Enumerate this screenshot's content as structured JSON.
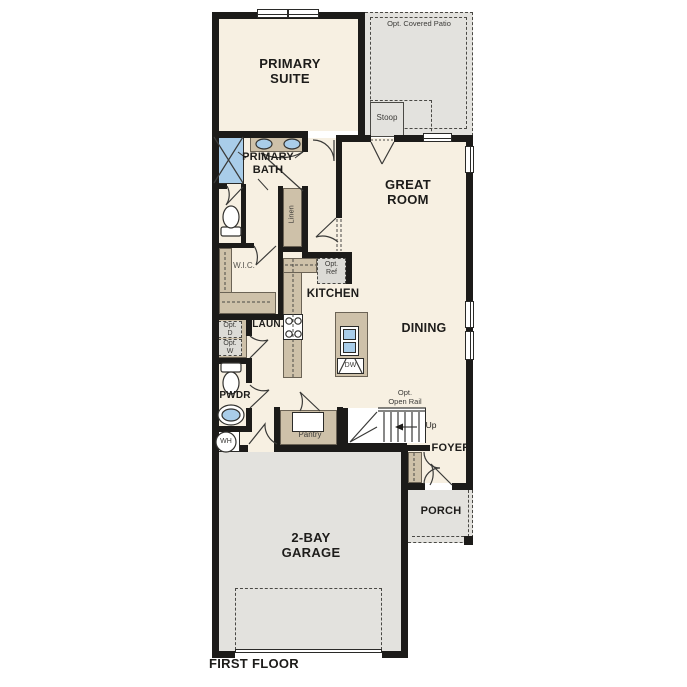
{
  "plan": {
    "title": "FIRST FLOOR",
    "rooms": {
      "primary_suite": "PRIMARY\nSUITE",
      "primary_bath": "PRIMARY\nBATH",
      "great_room": "GREAT\nROOM",
      "kitchen": "KITCHEN",
      "dining": "DINING",
      "walk_in_closet": "W.I.C.",
      "laundry": "LAUN.",
      "powder": "PWDR",
      "linen": "Linen",
      "pantry": "Pantry",
      "foyer": "FOYER",
      "porch": "PORCH",
      "garage": "2-BAY\nGARAGE",
      "stoop": "Stoop",
      "covered_patio": "Opt. Covered Patio"
    },
    "annotations": {
      "opt_refrigerator": "Opt.\nRef",
      "opt_dryer": "Opt.\nD",
      "opt_washer": "Opt.\nW",
      "opt_open_rail": "Opt.\nOpen Rail",
      "stairs_direction": "Up",
      "dishwasher": "DW",
      "water_heater": "WH"
    },
    "colors": {
      "interior_floor": "#f7f0e2",
      "exterior_surface": "#e3e2de",
      "wall": "#1c1b19",
      "casework": "#cec1a9",
      "plumbing_blue": "#a9cde9"
    }
  }
}
